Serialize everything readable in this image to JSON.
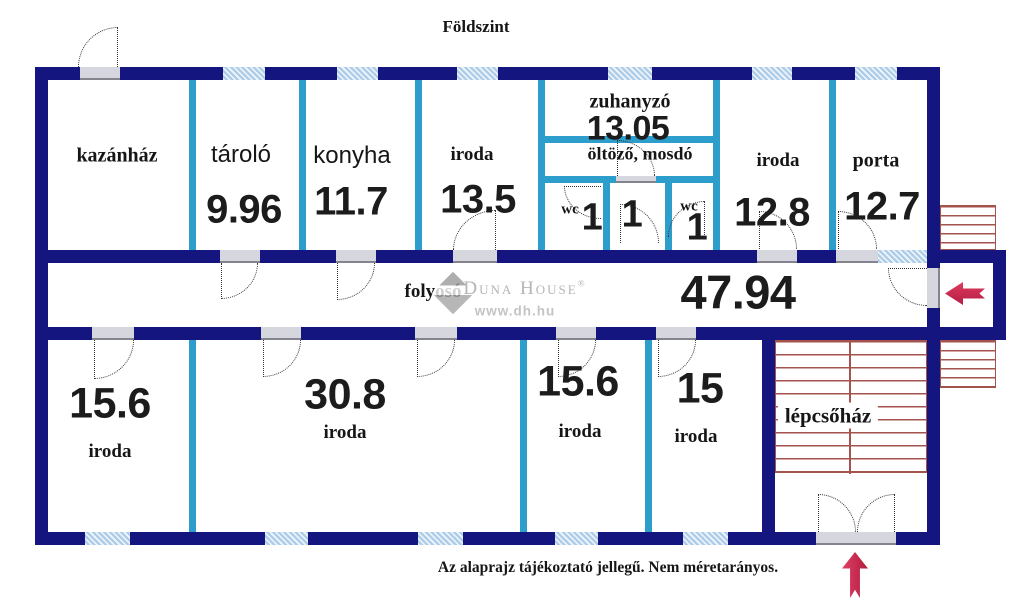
{
  "title": "Földszint",
  "disclaimer": "Az alaprajz tájékoztató jellegű. Nem méretarányos.",
  "watermark": {
    "brand": "Duna House",
    "reg": "®",
    "url": "www.dh.hu"
  },
  "icons": {
    "entrance-arrow": "←",
    "north-arrow": "↑"
  },
  "colors": {
    "outer_wall": "#15157f",
    "partition_wall": "#2d9ecb",
    "window_fill": "#aecde8",
    "stairs_red": "#a5534d",
    "arrow_red": "#cf2950",
    "text": "#161616",
    "watermark_gray": "#b5b5b5"
  },
  "rooms": {
    "kazanhaz": {
      "label": "kazánház"
    },
    "tarolo": {
      "label": "tároló",
      "area": "9.96"
    },
    "konyha": {
      "label": "konyha",
      "area": "11.7"
    },
    "iroda_felso": {
      "label": "iroda",
      "area": "13.5"
    },
    "zuhanyzo": {
      "label": "zuhanyzó",
      "area": "13.05"
    },
    "oltozo": {
      "label": "öltöző, mosdó"
    },
    "wc_bal": {
      "label": "wc",
      "area": "1"
    },
    "kozepso": {
      "area": "1"
    },
    "wc_jobb": {
      "label": "wc",
      "area": "1"
    },
    "iroda_128": {
      "label": "iroda",
      "area": "12.8"
    },
    "porta": {
      "label": "porta",
      "area": "12.7"
    },
    "folyoso": {
      "label": "folyosó",
      "area": "47.94"
    },
    "iroda_156a": {
      "label": "iroda",
      "area": "15.6"
    },
    "iroda_308": {
      "label": "iroda",
      "area": "30.8"
    },
    "iroda_156b": {
      "label": "iroda",
      "area": "15.6"
    },
    "iroda_15": {
      "label": "iroda",
      "area": "15"
    },
    "lepcsohaz": {
      "label": "lépcsőház"
    }
  }
}
